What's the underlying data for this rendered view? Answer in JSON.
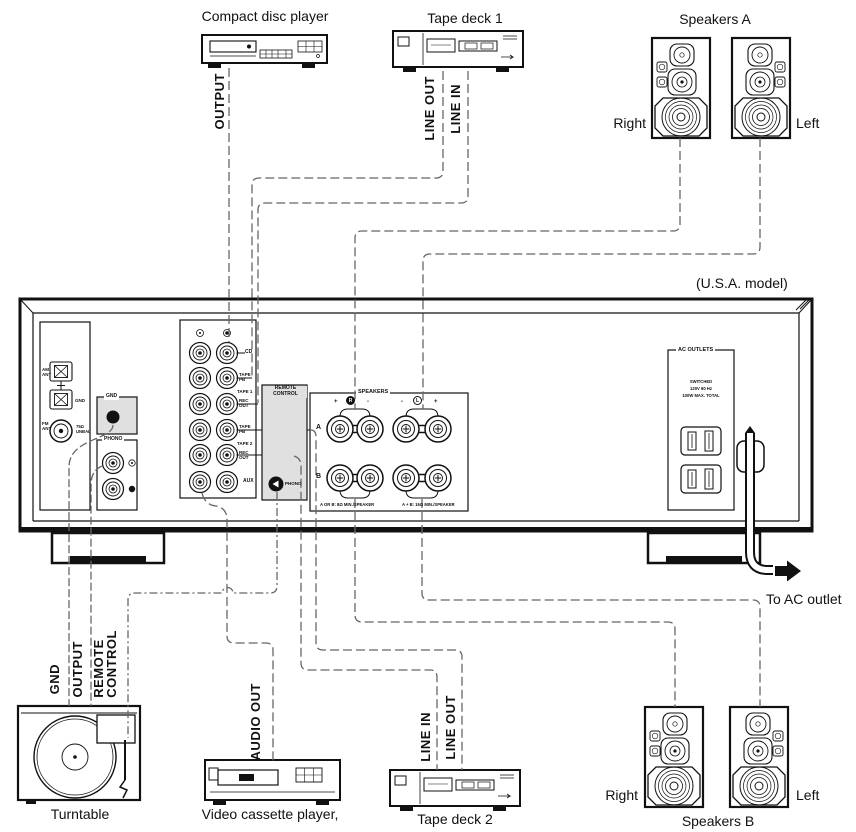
{
  "page": {
    "model_note": "(U.S.A. model)"
  },
  "devices": {
    "cd_player": {
      "title": "Compact disc player",
      "port_output": "OUTPUT"
    },
    "tape_deck_1": {
      "title": "Tape deck 1",
      "port_line_out": "LINE OUT",
      "port_line_in": "LINE IN"
    },
    "speakers_a": {
      "title": "Speakers A",
      "right": "Right",
      "left": "Left"
    },
    "turntable": {
      "title": "Turntable",
      "port_gnd": "GND",
      "port_output": "OUTPUT",
      "port_remote": "REMOTE\nCONTROL"
    },
    "vcr": {
      "title": "Video cassette player,",
      "port_audio_out": "AUDIO OUT"
    },
    "tape_deck_2": {
      "title": "Tape deck 2",
      "port_line_in": "LINE IN",
      "port_line_out": "LINE OUT"
    },
    "speakers_b": {
      "title": "Speakers B",
      "right": "Right",
      "left": "Left"
    }
  },
  "panel": {
    "antenna": {
      "am": "AM\nANT",
      "gnd": "GND",
      "fm": "FM\nANT",
      "unbal": "75Ω\nUNBAL"
    },
    "gnd_terminal": {
      "label": "GND"
    },
    "phono": {
      "label": "PHONO"
    },
    "inputs": {
      "cd": "CD",
      "tape1_pb": "TAPE\nPB",
      "tape1": "TAPE 1",
      "tape1_rec": "REC\nOUT",
      "tape2_pb": "TAPE\nPB",
      "tape2": "TAPE 2",
      "tape2_rec": "REC\nOUT",
      "aux": "AUX"
    },
    "remote": {
      "label": "REMOTE\nCONTROL",
      "jack": "PHONO"
    },
    "speakers": {
      "label": "SPEAKERS",
      "plus_left": "+",
      "r": "R",
      "minus_left": "-",
      "minus_right": "-",
      "l": "L",
      "plus_right": "+",
      "row_a": "A",
      "row_b": "B",
      "note_ab": "A OR B: 8Ω MIN./SPEAKER",
      "note_aplusb": "A + B: 16Ω MIN./SPEAKER"
    },
    "ac_outlets": {
      "label": "AC OUTLETS",
      "info": "SWITCHED\n120V 60 Hz\n100W MAX. TOTAL"
    },
    "to_ac_outlet": "To AC outlet"
  }
}
